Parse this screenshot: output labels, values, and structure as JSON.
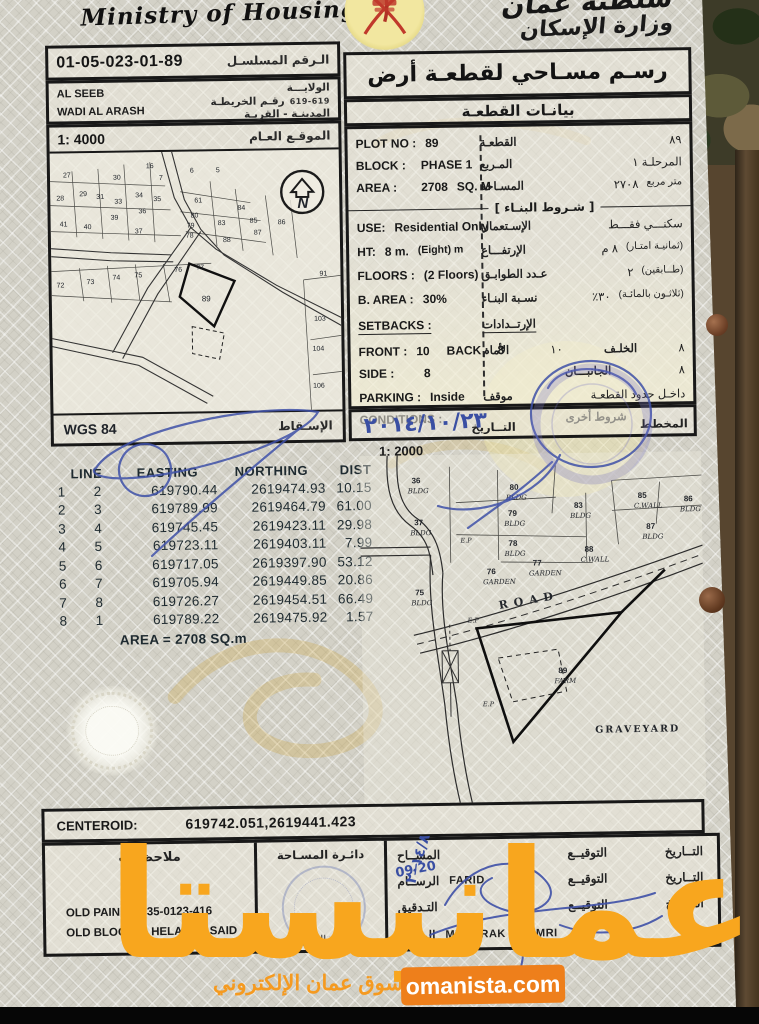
{
  "brand": {
    "name_ar": "عمانيستا",
    "tagline_ar": "سوق عمان الإلكتروني",
    "site": "omanista.com",
    "accent": "#EE7F1B"
  },
  "header": {
    "ministry_en": "Ministry of Housing",
    "sultanate_ar": "سلطنة عُمان",
    "ministry_ar": "وزارة الإسكان"
  },
  "meta": {
    "serial": "01-05-023-01-89",
    "serial_label_ar": "الـرقم المسلسـل",
    "wilayat": "AL SEEB",
    "village": "WADI AL ARASH",
    "wilayat_label_ar": "الولايـــة",
    "map_no_label_ar": "رقـم الخريطـة",
    "map_no": "619-619",
    "city_village_label_ar": "المدينـة - القريـة"
  },
  "overview_map": {
    "scale": "1: 4000",
    "title_ar": "الموقـع العـام",
    "north": "N",
    "datum": "WGS 84",
    "projection_ar": "الإسـقاط",
    "labels": [
      {
        "t": "27",
        "x": 13,
        "y": 24
      },
      {
        "t": "30",
        "x": 63,
        "y": 27
      },
      {
        "t": "16",
        "x": 96,
        "y": 16
      },
      {
        "t": "7",
        "x": 109,
        "y": 28
      },
      {
        "t": "6",
        "x": 140,
        "y": 21
      },
      {
        "t": "5",
        "x": 166,
        "y": 21
      },
      {
        "t": "28",
        "x": 6,
        "y": 47
      },
      {
        "t": "29",
        "x": 29,
        "y": 43
      },
      {
        "t": "31",
        "x": 46,
        "y": 46
      },
      {
        "t": "33",
        "x": 64,
        "y": 51
      },
      {
        "t": "34",
        "x": 85,
        "y": 45
      },
      {
        "t": "35",
        "x": 103,
        "y": 49
      },
      {
        "t": "61",
        "x": 144,
        "y": 51
      },
      {
        "t": "84",
        "x": 187,
        "y": 59
      },
      {
        "t": "41",
        "x": 9,
        "y": 73
      },
      {
        "t": "40",
        "x": 33,
        "y": 76
      },
      {
        "t": "39",
        "x": 60,
        "y": 67
      },
      {
        "t": "36",
        "x": 88,
        "y": 61
      },
      {
        "t": "37",
        "x": 84,
        "y": 81
      },
      {
        "t": "80",
        "x": 140,
        "y": 66
      },
      {
        "t": "79",
        "x": 136,
        "y": 76
      },
      {
        "t": "83",
        "x": 167,
        "y": 74
      },
      {
        "t": "85",
        "x": 199,
        "y": 72
      },
      {
        "t": "86",
        "x": 227,
        "y": 74
      },
      {
        "t": "78",
        "x": 135,
        "y": 86
      },
      {
        "t": "87",
        "x": 203,
        "y": 84
      },
      {
        "t": "88",
        "x": 172,
        "y": 91
      },
      {
        "t": "72",
        "x": 5,
        "y": 134
      },
      {
        "t": "73",
        "x": 35,
        "y": 131
      },
      {
        "t": "74",
        "x": 61,
        "y": 127
      },
      {
        "t": "75",
        "x": 83,
        "y": 125
      },
      {
        "t": "76",
        "x": 123,
        "y": 120
      },
      {
        "t": "77",
        "x": 145,
        "y": 118
      },
      {
        "t": "91",
        "x": 268,
        "y": 126
      },
      {
        "t": "89",
        "x": 150,
        "y": 150,
        "b": 1
      },
      {
        "t": "103",
        "x": 262,
        "y": 171
      },
      {
        "t": "104",
        "x": 260,
        "y": 201
      },
      {
        "t": "106",
        "x": 260,
        "y": 238
      }
    ]
  },
  "plot_info": {
    "title_ar": "رسـم مسـاحي لقطعـة أرض",
    "subtitle_ar": "بيانـات القطعـة",
    "plot_no_label": "PLOT NO :",
    "plot_no": "89",
    "plot_no_ar": "٨٩",
    "plot_label_ar": "القطعـة",
    "block_label": "BLOCK :",
    "block": "PHASE 1",
    "block_ar": "المرحلـة ١",
    "block_label_ar": "المـربع",
    "area_label": "AREA :",
    "area": "2708",
    "area_unit": "SQ. M",
    "area_ar": "٢٧٠٨",
    "area_unit_ar": "متر مربع",
    "area_label_ar": "المسـاحة",
    "conditions_title_ar": "[ شـروط البنـاء ]",
    "use_label": "USE:",
    "use_value": "Residential Only",
    "use_ar": "سكنـــي فقـــط",
    "use_label_ar": "الإسـتعمال",
    "ht_label": "HT:",
    "ht_value": "8 m.",
    "ht_note": "(Eight) m",
    "ht_ar": "٨ م",
    "ht_note_ar": "(ثمانيـة امتـار)",
    "ht_label_ar": "الإرتفـــاع",
    "floors_label": "FLOORS :",
    "floors_value": "(2 Floors)",
    "floors_ar": "٢",
    "floors_note_ar": "(طــابقين)",
    "floors_label_ar": "عـدد الطوابـق",
    "barea_label": "B. AREA :",
    "barea_value": "30%",
    "barea_ar": "٣٠٪",
    "barea_note_ar": "(ثلاثـون بالمائـة)",
    "barea_label_ar": "نسـبة البنـاء",
    "setbacks_label": "SETBACKS :",
    "setbacks_label_ar": "الإرتــدادات",
    "front_label": "FRONT :",
    "front_value": "10",
    "back_label": "BACK :",
    "back_value": "8",
    "front_label_ar": "الأمام",
    "front_value_ar": "١٠",
    "back_label_ar": "الخلـف",
    "back_value_ar": "٨",
    "side_label": "SIDE :",
    "side_value": "8",
    "side_label_ar": "الجانبـــان",
    "side_value_ar": "٨",
    "parking_label": "PARKING :",
    "parking_value": "Inside",
    "parking_ar": "داخـل حدود القطعـة",
    "parking_label_ar": "موقف",
    "conditions_label": "CONDITIONS :",
    "other_conditions_ar": "شروط أخرى",
    "date_label_ar": "التــاريخ",
    "date_value_ar": "٢٠١٤/١٠/٢٣",
    "plan_label_ar": "المخطط"
  },
  "coords": {
    "headers": [
      "LINE",
      "EASTING",
      "NORTHING",
      "DIST"
    ],
    "rows": [
      [
        "1",
        "2",
        "619790.44",
        "2619474.93",
        "10.15"
      ],
      [
        "2",
        "3",
        "619789.99",
        "2619464.79",
        "61.00"
      ],
      [
        "3",
        "4",
        "619745.45",
        "2619423.11",
        "29.98"
      ],
      [
        "4",
        "5",
        "619723.11",
        "2619403.11",
        "7.99"
      ],
      [
        "5",
        "6",
        "619717.05",
        "2619397.90",
        "53.12"
      ],
      [
        "6",
        "7",
        "619705.94",
        "2619449.85",
        "20.86"
      ],
      [
        "7",
        "8",
        "619726.27",
        "2619454.51",
        "66.49"
      ],
      [
        "8",
        "1",
        "619789.22",
        "2619475.92",
        "1.57"
      ]
    ],
    "area_total": "AREA = 2708  SQ.m"
  },
  "detail_map": {
    "scale": "1: 2000",
    "road": "ROAD",
    "graveyard": "GRAVEYARD",
    "ep": "E.P",
    "labels": [
      {
        "t": "36",
        "s": "BLDG",
        "x": 52,
        "y": 28
      },
      {
        "t": "37",
        "s": "BLDG",
        "x": 54,
        "y": 70
      },
      {
        "t": "80",
        "s": "BLDG",
        "x": 150,
        "y": 36
      },
      {
        "t": "79",
        "s": "BLDG",
        "x": 148,
        "y": 62
      },
      {
        "t": "78",
        "s": "BLDG",
        "x": 148,
        "y": 92
      },
      {
        "t": "83",
        "s": "BLDG",
        "x": 214,
        "y": 55
      },
      {
        "t": "85",
        "s": "C.WALL",
        "x": 278,
        "y": 46
      },
      {
        "t": "86",
        "s": "BLDG",
        "x": 324,
        "y": 50
      },
      {
        "t": "87",
        "s": "BLDG",
        "x": 286,
        "y": 77
      },
      {
        "t": "88",
        "s": "C.WALL",
        "x": 224,
        "y": 99
      },
      {
        "t": "76",
        "s": "GARDEN",
        "x": 126,
        "y": 120
      },
      {
        "t": "77",
        "s": "GARDEN",
        "x": 172,
        "y": 112
      },
      {
        "t": "75",
        "s": "BLDG",
        "x": 54,
        "y": 140
      },
      {
        "t": "89",
        "s": "FARM",
        "x": 196,
        "y": 220,
        "b": 1
      }
    ]
  },
  "centeroid": {
    "label": "CENTEROID:",
    "value": "619742.051,2619441.423"
  },
  "footer": {
    "notes_title_ar": "ملاحظـات",
    "old_pain_label": "OLD PAIN  :",
    "old_pain_value": "1-35-0123-416",
    "old_block_label": "OLD BLOCK  :",
    "old_block_value": "HELAT AL SAID",
    "survey_dept_ar": "دائـرة المسـاحة",
    "dept_stamp_ar": "ختم الدائرة",
    "surveyor_label_ar": "المســاح",
    "draftsman_label_ar": "الرســام",
    "checker_label_ar": "التـدقيق",
    "manager_label_ar": "المــدير",
    "sign_label_ar": "التوقيــع",
    "date_label_ar": "التــاريخ",
    "draftsman_name": "FARID",
    "manager_name": "MUBARAK AL AMRI",
    "hand_date_1": "09/20",
    "hand_date_2": "٢٠١٤/٨"
  }
}
